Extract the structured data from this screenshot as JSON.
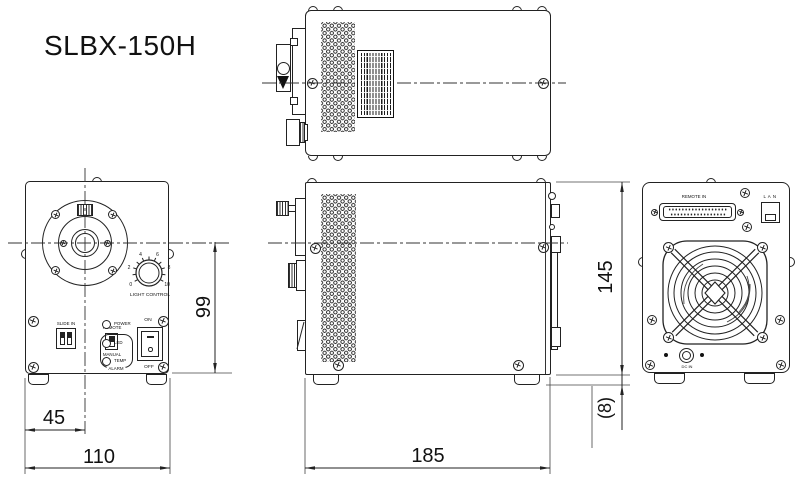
{
  "drawing": {
    "title": "SLBX-150H",
    "front_panel": {
      "light_control": "LIGHT CONTROL",
      "knob_scale": [
        "0",
        "2",
        "4",
        "6",
        "8",
        "10"
      ],
      "dip_label": "SLIDE IN",
      "remote": "REMOTE",
      "manual": "MANUAL",
      "power": "POWER",
      "led": "LED",
      "temp": "TEMP",
      "alarm": "ALARM",
      "on": "ON",
      "off": "OFF"
    },
    "rear_panel": {
      "remote_in": "REMOTE IN",
      "lan": "L A N",
      "dc_in": "DC IN"
    },
    "dimensions": {
      "front_axis_offset": "45",
      "front_width": "110",
      "depth": "185",
      "axis_height": "99",
      "body_height": "145",
      "foot_height": "(8)"
    }
  }
}
